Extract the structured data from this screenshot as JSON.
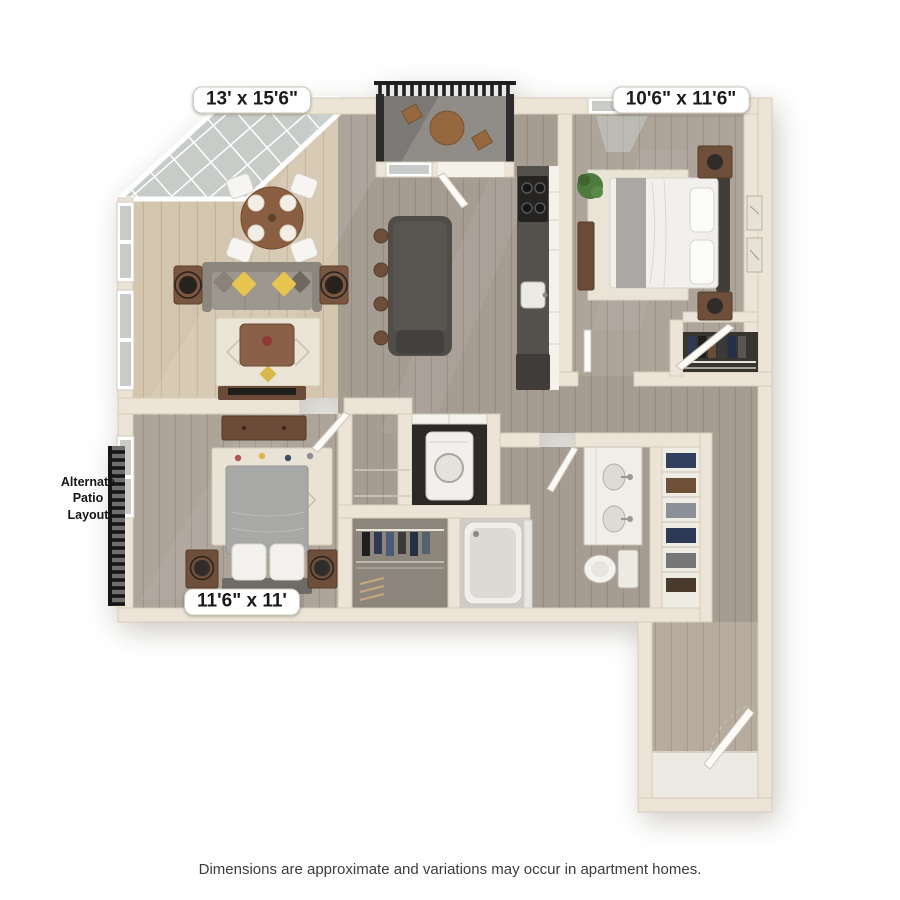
{
  "labels": {
    "living_dining_dimensions": "13' x 15'6\"",
    "bedroom_top_right_dimensions": "10'6\" x 11'6\"",
    "bedroom_bottom_left_dimensions": "11'6\" x 11'",
    "alternate_patio": "Alternate Patio Layout",
    "disclaimer": "Dimensions are approximate and variations may occur in apartment homes."
  },
  "colors": {
    "wall": "#ece5d7",
    "floor_light_wood": "#d4c6ae",
    "floor_gray_wood": "#a59c92",
    "floor_bedroom_wood": "#ada49a",
    "island_counter": "#504d49",
    "glass": "#c9cdc9",
    "railing": "#222222",
    "accent_pillow_yellow": "#e6c44f"
  }
}
